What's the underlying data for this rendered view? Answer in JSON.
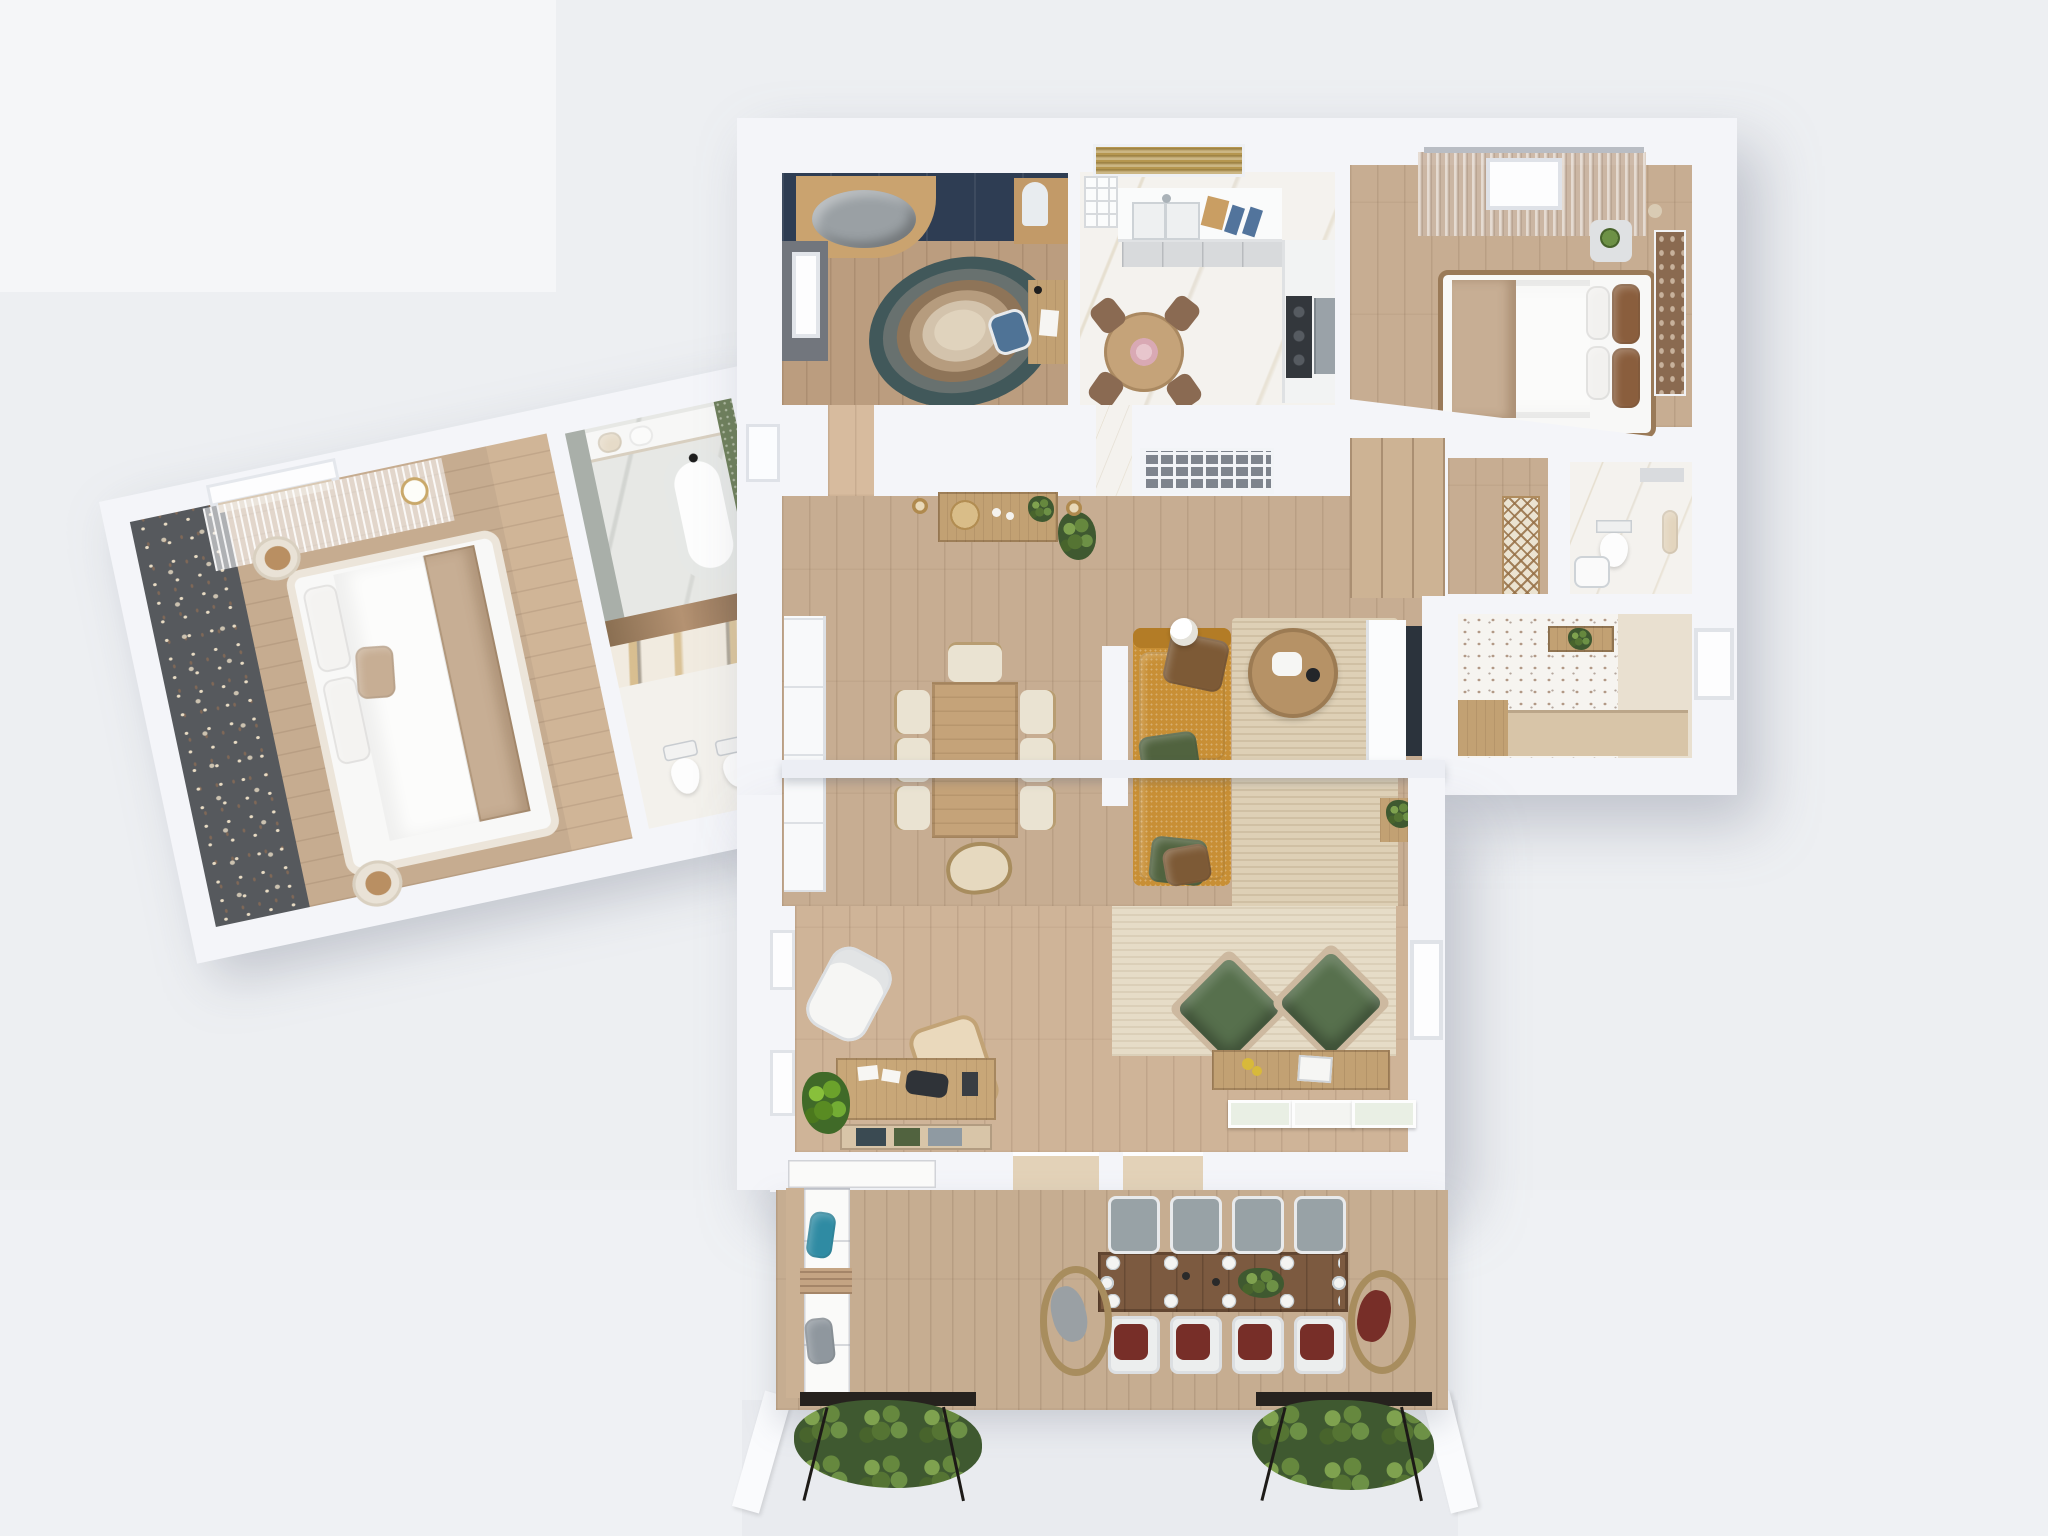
{
  "scene": {
    "kind": "photorealistic 3D floor plan render",
    "view": "top-down axonometric",
    "unit": "single-storey apartment with terrace",
    "left_wing_rotation_deg": -12
  },
  "palette": {
    "bg": "#edeff2",
    "bgLight": "#f5f6f8",
    "wall": "#f4f5f9",
    "beam": "#eceef4",
    "woodMain": "#c7ad92",
    "woodOffice": "#bb9d7f",
    "woodWing": "#c6ac90",
    "woodDeck": "#c6ad91",
    "marble": "#f4f2ee",
    "speckBase": "#f6f4f0",
    "mosaic": "#6e7f5b",
    "floral": "#56595d",
    "floralDot": "#e9dcc4",
    "navy": "#2e3d53",
    "darkWall": "#72767d",
    "jute": "#ded0b6",
    "lowRug": "#e6dcc7",
    "sofa": "#c88f35",
    "pillowGreen": "#51633f",
    "throwBrown": "#7d5a36",
    "coffee": "#b69266",
    "tableWood": "#c5a379",
    "chairCream": "#eae3d2",
    "chairBrown": "#8a6a52",
    "tv": "#2b333c",
    "console": "#c2a173",
    "armGreen": "#57704d",
    "deskWood": "#c8a778",
    "monitor": "#2f3338",
    "terrTable": "#7c5a40",
    "chairGray": "#98a2a6",
    "cushRed": "#772e28",
    "wicker": "#a88d5e",
    "bedWhite": "#f8f8f7",
    "bedFrame": "#ece5da",
    "blanket": "#c7ae94",
    "pillowBrown": "#8a5e3d",
    "blind": "#b5964f",
    "teal": "#2f8ba3",
    "grayPillow": "#8f979e",
    "apron": "#e9ebef",
    "rugTeal": "#41585a",
    "rugSlate": "#68716f",
    "rugBrown": "#8e7458",
    "rugTan": "#b69c7e",
    "rugCream": "#d3c3ac",
    "rugCenter": "#e0d3bd"
  },
  "rooms": [
    {
      "id": "study-office",
      "name": "Study / kids room",
      "floor": "oak plank",
      "items": [
        "navy wardrobe wall",
        "curved wooden nook with gray cushion",
        "vanity with arch mirror",
        "layered oval rug (teal-brown-cream)",
        "writing desk",
        "blue office chair",
        "window"
      ]
    },
    {
      "id": "kitchen",
      "name": "Kitchen / breakfast",
      "floor": "white marble",
      "items": [
        "window with bronze roman blind",
        "open shelves",
        "double sink",
        "cutting board",
        "blue placemats",
        "lower cabinets",
        "cooktop",
        "oven column",
        "round wooden table",
        "pink flower centerpiece",
        "4 brown chairs"
      ]
    },
    {
      "id": "bedroom-right",
      "name": "Bedroom",
      "floor": "oak plank",
      "items": [
        "beige curtains on rail",
        "window",
        "double bed white duvet",
        "beige throw",
        "brown headboard pillows",
        "dried-flower wall art",
        "nightstand with plant",
        "vase"
      ]
    },
    {
      "id": "hallway",
      "name": "Hallway",
      "floor": "oak plank",
      "items": [
        "console table",
        "gold decorative tray",
        "two pendant lights",
        "hanging plant",
        "radiator grille",
        "entry door recess",
        "lattice wall art"
      ]
    },
    {
      "id": "living-dining",
      "name": "Living / dining",
      "floor": "oak plank",
      "items": [
        "white built-in storage",
        "dining table",
        "8 cream chairs",
        "mustard fabric sofa",
        "green pillows",
        "brown throws",
        "globe floor lamp",
        "round coffee table with tray",
        "jute rug",
        "white media cabinet",
        "wall TV",
        "plant console"
      ],
      "note": "wide openings with overhead beam and wall stub"
    },
    {
      "id": "lounge-study",
      "name": "Garden lounge / home office",
      "floor": "oak plank",
      "items": [
        "white swivel chair",
        "cane armchair",
        "desk with monitor, papers, speaker",
        "book shelf",
        "potted plant",
        "2 green lounge armchairs",
        "light rug",
        "media sideboard with yellow flowers and books",
        "3 leaning botanical frames",
        "2 glazed doors to terrace",
        "side windows"
      ]
    },
    {
      "id": "bathroom-right",
      "name": "WC",
      "floor": "white marble",
      "items": [
        "toilet",
        "towel",
        "wall shelf",
        "corner basin"
      ]
    },
    {
      "id": "office-nook",
      "name": "Utility / desk nook",
      "floor": "terrazzo speckle",
      "items": [
        "built-in desk",
        "wood cabinet",
        "shelf with plant",
        "window"
      ]
    },
    {
      "id": "master-bedroom",
      "name": "Master bedroom (rotated wing)",
      "floor": "oak plank",
      "items": [
        "dark floral blossom wallpaper",
        "skylight window with sheer curtain",
        "ceiling lamp",
        "double bed white duvet",
        "beige accent pillow",
        "beige foot throw",
        "2 round cream nightstands"
      ]
    },
    {
      "id": "bathroom-tub",
      "name": "Bathroom",
      "floor": "gray marble",
      "items": [
        "vanity with towels",
        "freestanding oval tub",
        "black faucet",
        "green mosaic wall",
        "bronze glass partition"
      ]
    },
    {
      "id": "wc-gold",
      "name": "Guest WC",
      "floor": "white stone",
      "items": [
        "gold-veined marble wall",
        "toilet",
        "bidet",
        "wood shelf"
      ]
    },
    {
      "id": "terrace",
      "name": "Terrace",
      "floor": "deck boards",
      "items": [
        "white L-shaped outdoor sofa",
        "teal pillow",
        "gray pillow",
        "slatted side table",
        "10-seat plank dining table",
        "plates and settings",
        "green centerpiece",
        "4 gray chairs",
        "4 chairs with dark red cushions",
        "2 rattan end chairs",
        "2 metal planters with greenery",
        "pergola posts"
      ]
    }
  ]
}
